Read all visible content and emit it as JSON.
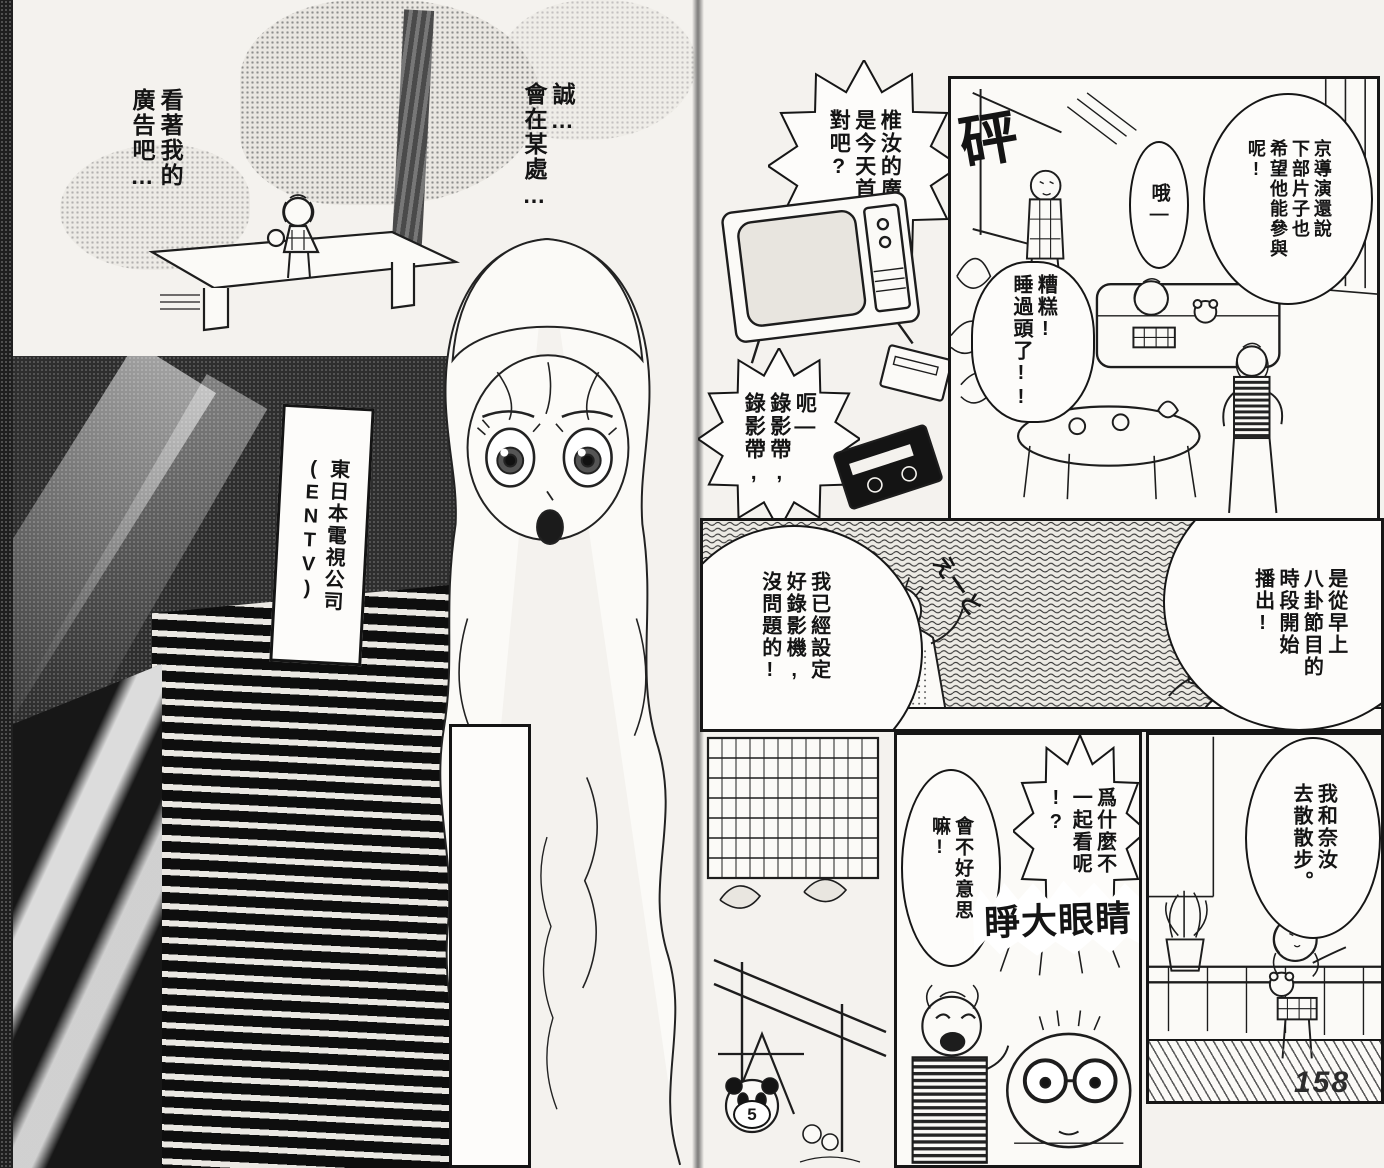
{
  "colors": {
    "paper": "#f4f2ee",
    "ink": "#161616"
  },
  "page_number": "158",
  "left_page": {
    "caption_watch_ad": "看著我的\n廣告吧…",
    "caption_somewhere": "誠…\n會在某處…",
    "building_sign": "東日本電視公司\n(ENTV)"
  },
  "right_page": {
    "bubble_premiere": "椎汝的廣告\n是今天首播\n對吧?",
    "bubble_tapes": "呃—\n錄影帶,\n錄影帶,",
    "sfx_bang": "砰",
    "living_room": {
      "bubble_director": "京導演還說\n下部片子也\n希望他能參與\n呢!",
      "bubble_oh": "哦—",
      "bubble_overslept": "糟糕!\n睡過頭了!!"
    },
    "vcr_panel": {
      "bubble_vcr": "我已經設定\n好錄影機,\n沒問題的!",
      "bubble_schedule": "是從早上\n八卦節目的\n時段開始\n播出!",
      "sfx_um": "えーと"
    },
    "watch_panel": {
      "bubble_why": "爲什麼不\n一起看呢\n!?",
      "bubble_shy": "會不好意思\n嘛!",
      "sfx_eyes": "睜大眼睛"
    },
    "walk_panel": {
      "bubble_walk": "我和奈汝\n去散散步。"
    },
    "playground_number": "5"
  }
}
